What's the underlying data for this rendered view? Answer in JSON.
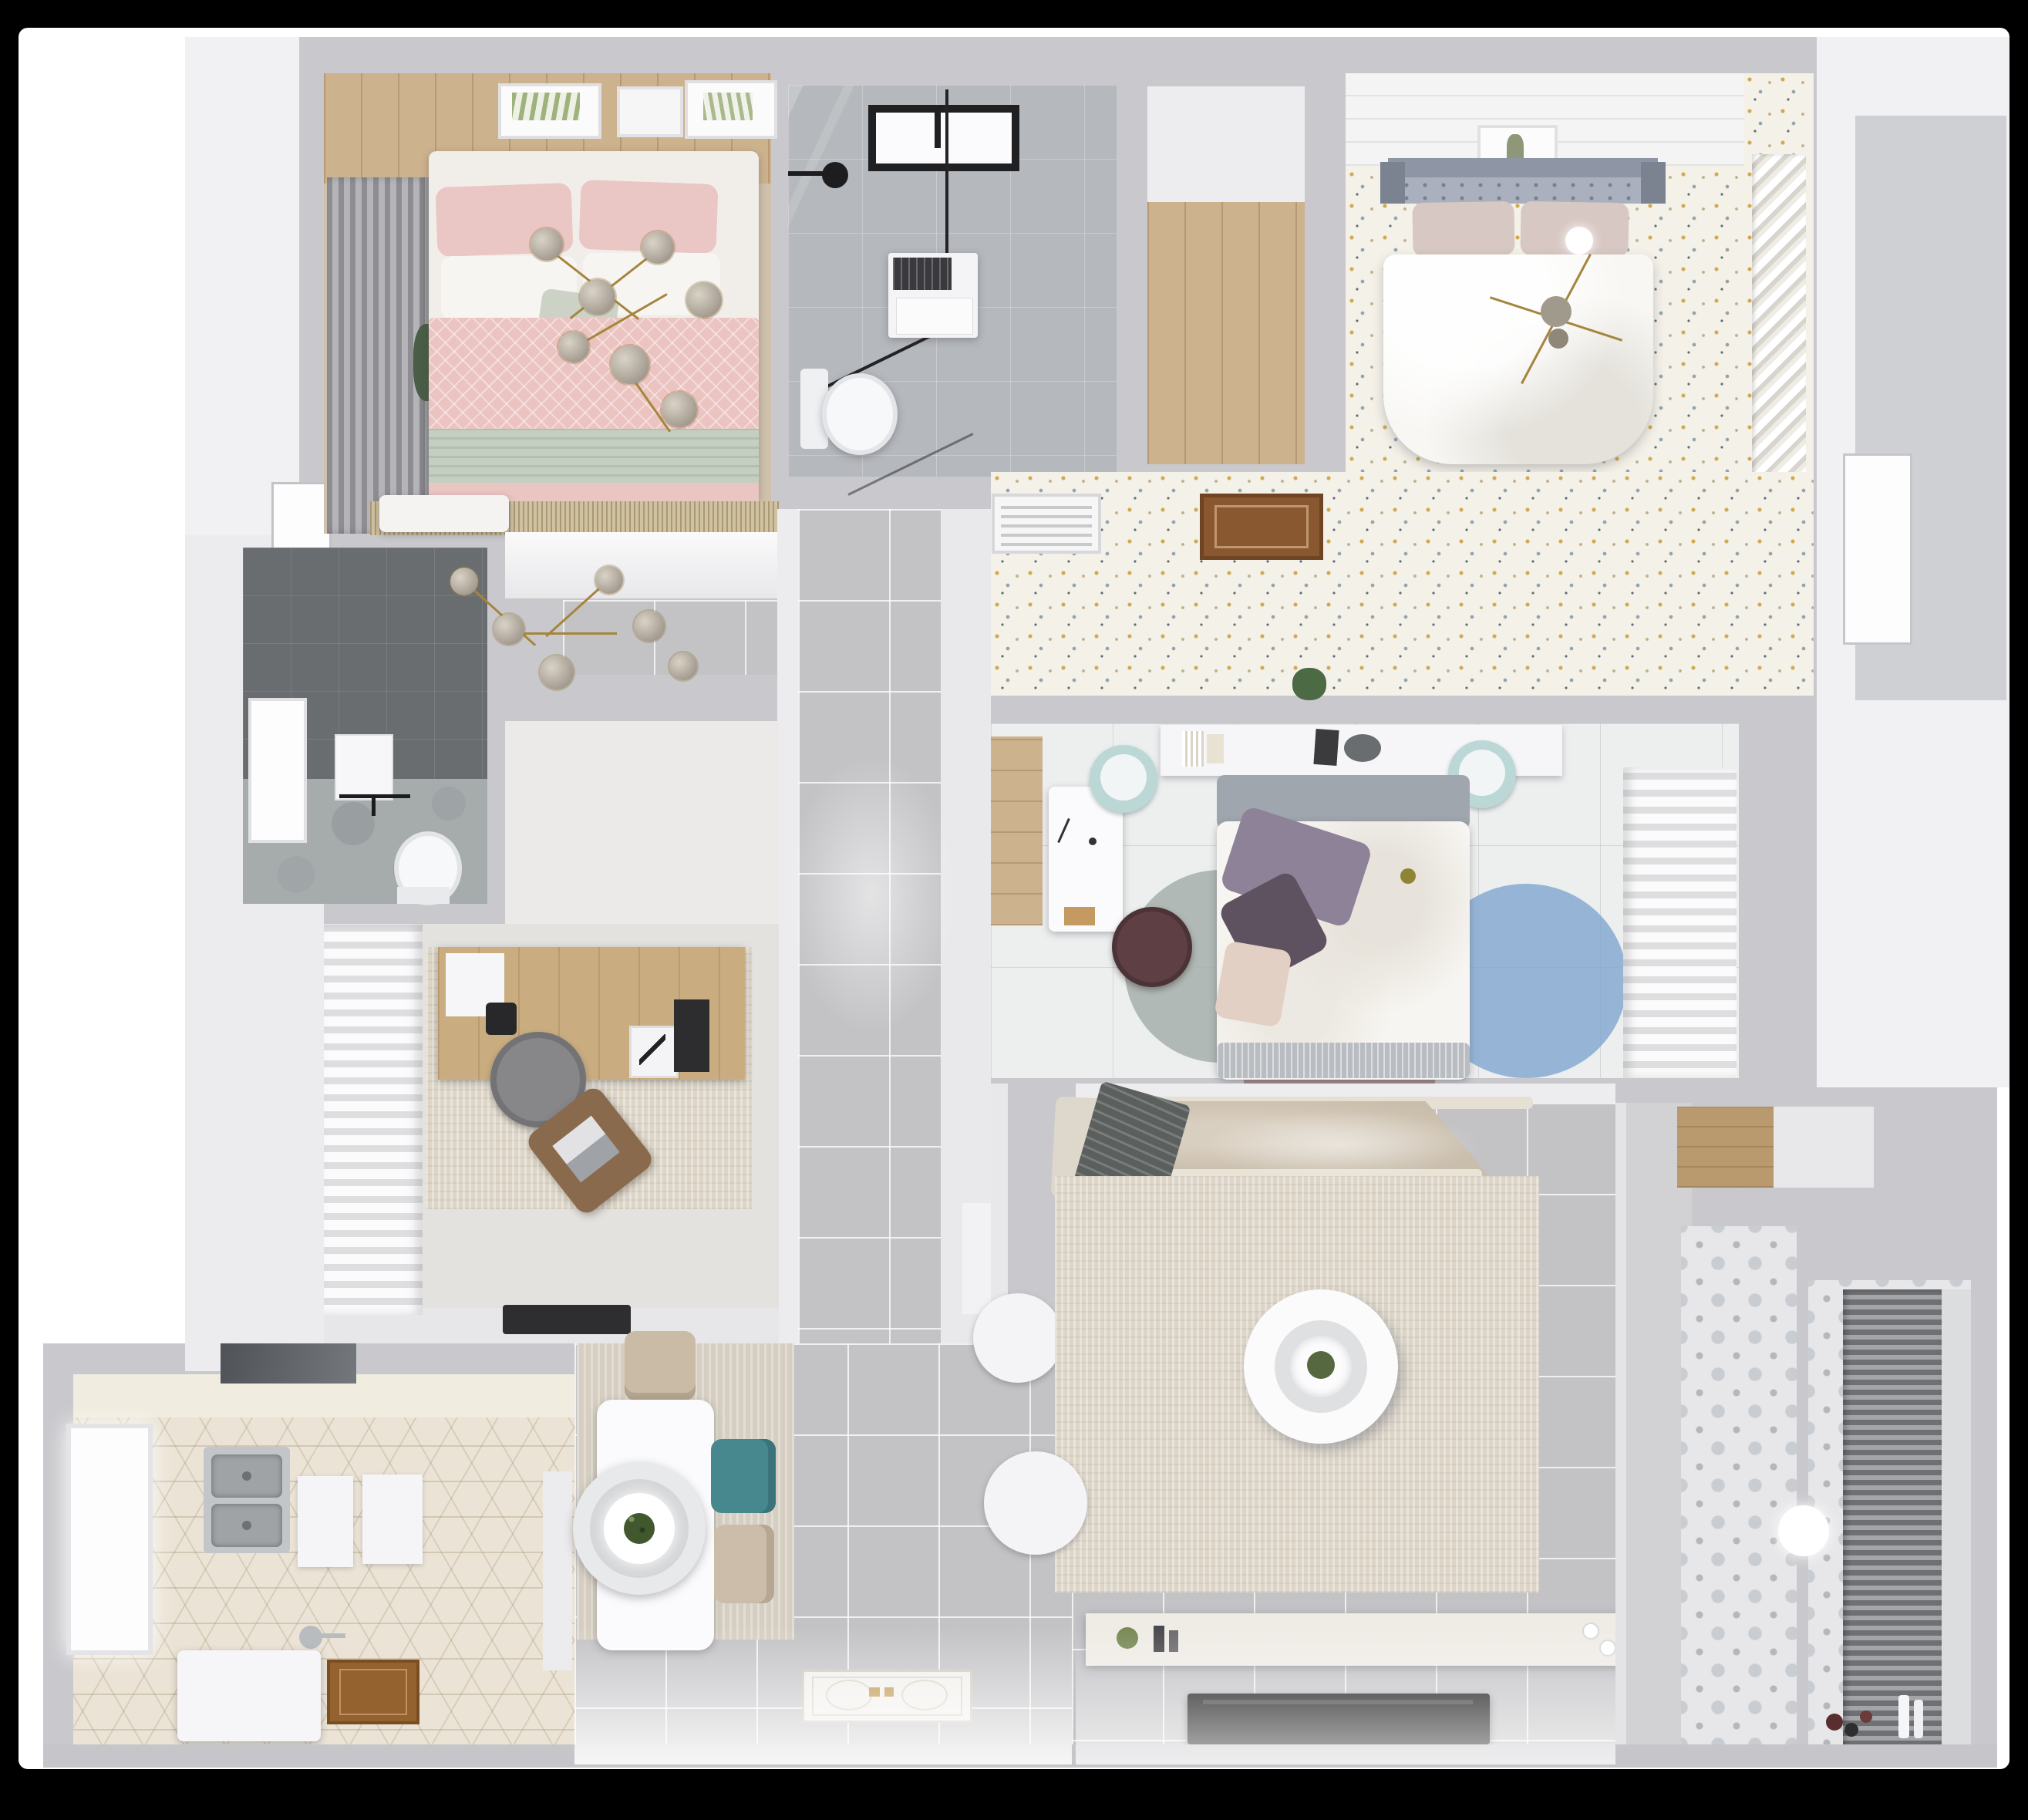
{
  "meta": {
    "type": "3d-floor-plan-rendering",
    "view": "top-down bird's-eye",
    "description": "Photorealistic 3D render of a furnished apartment floor plan on a white sheet over black background"
  },
  "palette": {
    "page_bg": "#000000",
    "canvas": "#ffffff",
    "wall": "#c9c9cd",
    "wall_lit": "#ececee",
    "tile_floor": "#c3c2c5",
    "wood_light": "#cdb28e",
    "wood_hatch": "#8a5830",
    "speckle_floor": "#f4f1e8",
    "marble_floor": "#b5b8bc",
    "dark_tile": "#6a6d6f",
    "hex_tile": "#ebe4d6",
    "pattern_tile": "#e7e7ea",
    "rug_cream": "#ddd6c8",
    "rug_fringe_tan": "#d0c1a1",
    "pink_bedding": "#ebc4c1",
    "sage_bedding": "#c4cfc2",
    "teal_chair": "#47888f",
    "teal_pouf": "#bcd8d6",
    "gold": "#a5853e",
    "headboard_blue_gray": "#9aa2b2",
    "rug_blue": "#7fa6cf",
    "rug_mauve": "#9b7f85",
    "rug_sage": "#a9b2ae",
    "sofa_beige": "#cfc4b2",
    "tv_black": "#141416",
    "blinds": "#6e7073"
  },
  "rooms": [
    {
      "id": "bedroom-pink",
      "name": "Bedroom 1 — pink double bed",
      "furniture": [
        "double-bed",
        "pink-duvet",
        "sage-runner",
        "pillows",
        "gray-curtains",
        "wall-art-frames",
        "gold-sputnik-chandelier",
        "second-chandelier",
        "bench",
        "fringe-rug",
        "plant"
      ]
    },
    {
      "id": "bathroom",
      "name": "Bathroom — walk-in shower, washer, toilet",
      "furniture": [
        "black-frame-window",
        "shower-enclosure",
        "shower-head",
        "washing-machine",
        "toilet"
      ]
    },
    {
      "id": "entry-closet",
      "name": "Entry closet — wood floor",
      "furniture": []
    },
    {
      "id": "bedroom-master",
      "name": "Master bedroom — white bed on speckled floor",
      "furniture": [
        "double-bed",
        "tufted-headboard",
        "blush-pillows",
        "sphere-lamp",
        "gold-sputnik-chandelier",
        "wall-art",
        "louver-closet",
        "plank-ceiling"
      ]
    },
    {
      "id": "vestibule",
      "name": "Vestibule — speckled wallpaper floor",
      "furniture": [
        "vent-grille",
        "wood-floor-hatch"
      ]
    },
    {
      "id": "hallway",
      "name": "Hallway — gray tile",
      "furniture": []
    },
    {
      "id": "shower-room",
      "name": "Shower room — dark tile",
      "furniture": [
        "window",
        "toilet",
        "wall-frame",
        "shower-fixture",
        "plant"
      ]
    },
    {
      "id": "study",
      "name": "Study — desk and chairs",
      "furniture": [
        "wood-desk",
        "desk-pad",
        "camera",
        "art-frames",
        "office-chair",
        "lounge-chair",
        "laptop",
        "distressed-rug",
        "white-curtains",
        "doormat"
      ]
    },
    {
      "id": "bedroom-middle",
      "name": "Middle bedroom — bed, desk, round rugs",
      "furniture": [
        "double-bed",
        "purple-pillows",
        "headboard-shelf",
        "books",
        "bowl",
        "teal-pouf-left",
        "teal-pouf-right",
        "white-desk",
        "maroon-chair",
        "round-rug-sage",
        "round-rug-mauve",
        "round-rug-blue",
        "wardrobe-curtains",
        "plant",
        "wood-strip"
      ]
    },
    {
      "id": "kitchen",
      "name": "Kitchen — hexagon tile",
      "furniture": [
        "range-hood",
        "double-stainless-sink",
        "window",
        "cutting-board-1",
        "cutting-board-2",
        "island-counter",
        "faucet",
        "wood-mat",
        "door-leaf"
      ]
    },
    {
      "id": "dining",
      "name": "Dining — table for four",
      "furniture": [
        "white-table",
        "ring-pendant-lamp",
        "beige-chair-top",
        "teal-chair",
        "beige-chair-bottom",
        "wood-grain-rug",
        "white-pouf",
        "entry-door-mat"
      ]
    },
    {
      "id": "living",
      "name": "Living room — corner sofa and TV",
      "furniture": [
        "corner-sofa",
        "chaise",
        "gray-throw",
        "cream-rug",
        "round-coffee-table",
        "tv-console",
        "console-decor",
        "flat-tv",
        "white-pouf"
      ]
    },
    {
      "id": "passage",
      "name": "Passage — patterned cement tile",
      "furniture": [
        "round-lamp"
      ]
    },
    {
      "id": "balcony",
      "name": "Balcony / laundry",
      "furniture": [
        "venetian-blinds",
        "patterned-tile",
        "toys",
        "white-bottles",
        "wood-shelf-niche",
        "exterior-door",
        "side-panel"
      ]
    }
  ]
}
